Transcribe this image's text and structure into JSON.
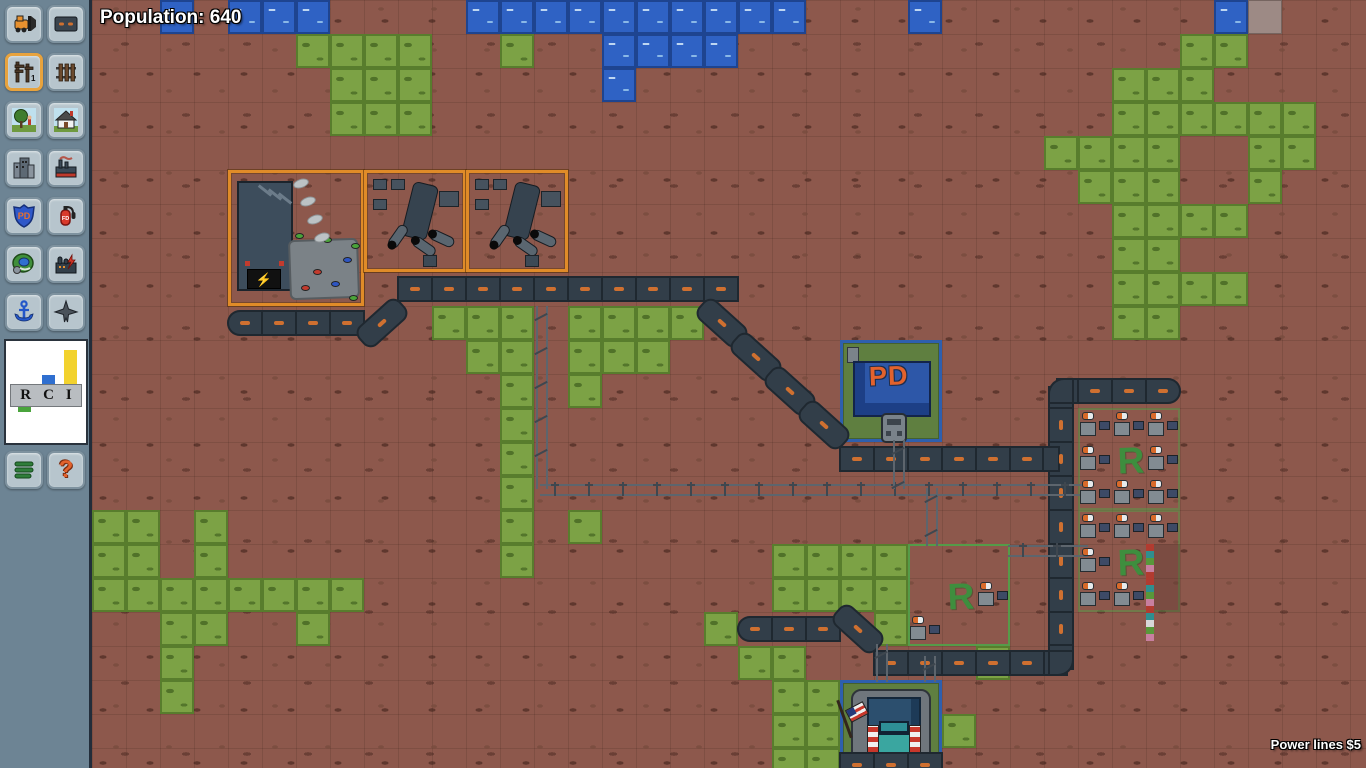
{
  "hud": {
    "population_label": "Population: 640",
    "status_label": "Power lines $5"
  },
  "sidebar": {
    "tools": [
      {
        "id": "bulldozer",
        "icon": "bulldozer-icon",
        "selected": false
      },
      {
        "id": "road",
        "icon": "road-icon",
        "selected": false
      },
      {
        "id": "power-lines",
        "icon": "power-lines-icon",
        "selected": true,
        "glyph": "1"
      },
      {
        "id": "rail",
        "icon": "rail-icon",
        "selected": false
      },
      {
        "id": "park",
        "icon": "park-icon",
        "selected": false
      },
      {
        "id": "residential",
        "icon": "residential-icon",
        "selected": false
      },
      {
        "id": "commercial",
        "icon": "commercial-icon",
        "selected": false
      },
      {
        "id": "industrial",
        "icon": "industrial-icon",
        "selected": false
      },
      {
        "id": "police",
        "icon": "police-icon",
        "selected": false,
        "glyph": "PD"
      },
      {
        "id": "fire",
        "icon": "fire-icon",
        "selected": false,
        "glyph": "FD"
      },
      {
        "id": "stadium",
        "icon": "stadium-icon",
        "selected": false
      },
      {
        "id": "power-plant",
        "icon": "power-plant-icon",
        "selected": false
      },
      {
        "id": "seaport",
        "icon": "anchor-icon",
        "selected": false
      },
      {
        "id": "airport",
        "icon": "airplane-icon",
        "selected": false
      }
    ],
    "rci": {
      "labels": {
        "r": "R",
        "c": "C",
        "i": "I"
      },
      "bars": {
        "r": -7,
        "c": 9,
        "i": 34
      },
      "colors": {
        "r": "#4aa43c",
        "c": "#2f6fd0",
        "i": "#f2d22e"
      }
    },
    "menu_icon": "menu-icon",
    "help_icon": "help-icon",
    "help_glyph": "?"
  },
  "colors": {
    "dirt": "#8d584c",
    "grass": "#7ca245",
    "water": "#2f62c4",
    "road": "#323e49",
    "road_dash": "#cf7030",
    "zone_orange": "#e08b28",
    "zone_blue": "#2e5fae",
    "zone_green": "#50a349",
    "r_letter": "#3e8e3e",
    "pd_text": "#e2622d",
    "selected_tool": "#e8a33d",
    "power_line": "#5d656d"
  },
  "map": {
    "tile_size": 34,
    "cols": 38,
    "rows": 23,
    "water": [
      [
        2,
        0
      ],
      [
        4,
        0
      ],
      [
        5,
        0
      ],
      [
        6,
        0
      ],
      [
        11,
        0
      ],
      [
        12,
        0
      ],
      [
        13,
        0
      ],
      [
        14,
        0
      ],
      [
        15,
        0
      ],
      [
        16,
        0
      ],
      [
        17,
        0
      ],
      [
        18,
        0
      ],
      [
        19,
        0
      ],
      [
        20,
        0
      ],
      [
        24,
        0
      ],
      [
        33,
        0
      ],
      [
        15,
        1
      ],
      [
        16,
        1
      ],
      [
        17,
        1
      ],
      [
        18,
        1
      ],
      [
        15,
        2
      ]
    ],
    "grass": [
      [
        6,
        1
      ],
      [
        7,
        1
      ],
      [
        8,
        1
      ],
      [
        9,
        1
      ],
      [
        12,
        1
      ],
      [
        32,
        1
      ],
      [
        33,
        1
      ],
      [
        7,
        2
      ],
      [
        8,
        2
      ],
      [
        9,
        2
      ],
      [
        30,
        2
      ],
      [
        31,
        2
      ],
      [
        32,
        2
      ],
      [
        7,
        3
      ],
      [
        8,
        3
      ],
      [
        9,
        3
      ],
      [
        30,
        3
      ],
      [
        31,
        3
      ],
      [
        32,
        3
      ],
      [
        33,
        3
      ],
      [
        34,
        3
      ],
      [
        35,
        3
      ],
      [
        28,
        4
      ],
      [
        29,
        4
      ],
      [
        30,
        4
      ],
      [
        31,
        4
      ],
      [
        34,
        4
      ],
      [
        35,
        4
      ],
      [
        29,
        5
      ],
      [
        30,
        5
      ],
      [
        31,
        5
      ],
      [
        34,
        5
      ],
      [
        30,
        6
      ],
      [
        31,
        6
      ],
      [
        32,
        6
      ],
      [
        33,
        6
      ],
      [
        30,
        7
      ],
      [
        31,
        7
      ],
      [
        30,
        8
      ],
      [
        31,
        8
      ],
      [
        32,
        8
      ],
      [
        33,
        8
      ],
      [
        10,
        9
      ],
      [
        11,
        9
      ],
      [
        12,
        9
      ],
      [
        14,
        9
      ],
      [
        15,
        9
      ],
      [
        16,
        9
      ],
      [
        17,
        9
      ],
      [
        30,
        9
      ],
      [
        31,
        9
      ],
      [
        11,
        10
      ],
      [
        12,
        10
      ],
      [
        14,
        10
      ],
      [
        15,
        10
      ],
      [
        16,
        10
      ],
      [
        12,
        11
      ],
      [
        14,
        11
      ],
      [
        12,
        12
      ],
      [
        12,
        13
      ],
      [
        12,
        14
      ],
      [
        0,
        15
      ],
      [
        1,
        15
      ],
      [
        3,
        15
      ],
      [
        12,
        15
      ],
      [
        14,
        15
      ],
      [
        0,
        16
      ],
      [
        1,
        16
      ],
      [
        3,
        16
      ],
      [
        12,
        16
      ],
      [
        20,
        16
      ],
      [
        21,
        16
      ],
      [
        22,
        16
      ],
      [
        23,
        16
      ],
      [
        0,
        17
      ],
      [
        1,
        17
      ],
      [
        2,
        17
      ],
      [
        3,
        17
      ],
      [
        4,
        17
      ],
      [
        5,
        17
      ],
      [
        6,
        17
      ],
      [
        7,
        17
      ],
      [
        20,
        17
      ],
      [
        21,
        17
      ],
      [
        22,
        17
      ],
      [
        23,
        17
      ],
      [
        2,
        18
      ],
      [
        3,
        18
      ],
      [
        6,
        18
      ],
      [
        18,
        18
      ],
      [
        23,
        18
      ],
      [
        2,
        19
      ],
      [
        19,
        19
      ],
      [
        20,
        19
      ],
      [
        26,
        19
      ],
      [
        2,
        20
      ],
      [
        20,
        20
      ],
      [
        21,
        20
      ],
      [
        20,
        21
      ],
      [
        21,
        21
      ],
      [
        25,
        21
      ],
      [
        20,
        22
      ],
      [
        21,
        22
      ]
    ],
    "light": [
      [
        34,
        0
      ]
    ],
    "roads": [
      [
        4,
        9,
        "el"
      ],
      [
        5,
        9,
        "h"
      ],
      [
        6,
        9,
        "h"
      ],
      [
        7,
        9,
        "h"
      ],
      [
        8,
        9,
        "du"
      ],
      [
        9,
        8,
        "h"
      ],
      [
        10,
        8,
        "h"
      ],
      [
        11,
        8,
        "h"
      ],
      [
        12,
        8,
        "h"
      ],
      [
        13,
        8,
        "h"
      ],
      [
        14,
        8,
        "h"
      ],
      [
        15,
        8,
        "h"
      ],
      [
        16,
        8,
        "h"
      ],
      [
        17,
        8,
        "h"
      ],
      [
        18,
        8,
        "h"
      ],
      [
        18,
        9,
        "dd"
      ],
      [
        19,
        10,
        "dd"
      ],
      [
        20,
        11,
        "dd"
      ],
      [
        21,
        12,
        "dd"
      ],
      [
        22,
        13,
        "h"
      ],
      [
        23,
        13,
        "h"
      ],
      [
        24,
        13,
        "h"
      ],
      [
        25,
        13,
        "h"
      ],
      [
        26,
        13,
        "h"
      ],
      [
        27,
        13,
        "h"
      ],
      [
        28,
        11,
        "ces"
      ],
      [
        29,
        11,
        "h"
      ],
      [
        30,
        11,
        "h"
      ],
      [
        31,
        11,
        "er"
      ],
      [
        28,
        12,
        "v"
      ],
      [
        28,
        13,
        "tw"
      ],
      [
        28,
        14,
        "v"
      ],
      [
        28,
        15,
        "v"
      ],
      [
        28,
        16,
        "v"
      ],
      [
        28,
        17,
        "v"
      ],
      [
        28,
        18,
        "v"
      ],
      [
        28,
        19,
        "cnw"
      ],
      [
        19,
        18,
        "el"
      ],
      [
        20,
        18,
        "h"
      ],
      [
        21,
        18,
        "h"
      ],
      [
        22,
        18,
        "dd"
      ],
      [
        23,
        19,
        "h"
      ],
      [
        24,
        19,
        "h"
      ],
      [
        25,
        19,
        "h"
      ],
      [
        26,
        19,
        "h"
      ],
      [
        27,
        19,
        "h"
      ],
      [
        22,
        22,
        "h"
      ],
      [
        23,
        22,
        "h"
      ],
      [
        24,
        22,
        "h"
      ]
    ],
    "power_lines": [
      {
        "dir": "v",
        "x": 448,
        "y1": 306,
        "y2": 489
      },
      {
        "dir": "h",
        "y": 488,
        "x1": 448,
        "x2": 992
      },
      {
        "dir": "v",
        "x": 805,
        "y1": 440,
        "y2": 489
      },
      {
        "dir": "v",
        "x": 838,
        "y1": 488,
        "y2": 546
      },
      {
        "dir": "h",
        "y": 549,
        "x1": 916,
        "x2": 996
      },
      {
        "dir": "v",
        "x": 788,
        "y1": 644,
        "y2": 682
      },
      {
        "dir": "v",
        "x": 836,
        "y1": 656,
        "y2": 682
      }
    ],
    "zones": [
      {
        "type": "power-plant",
        "c": 4,
        "r": 5,
        "w": 4,
        "h": 4,
        "border": "orange"
      },
      {
        "type": "industrial",
        "c": 8,
        "r": 5,
        "w": 3,
        "h": 3,
        "border": "orange"
      },
      {
        "type": "industrial",
        "c": 11,
        "r": 5,
        "w": 3,
        "h": 3,
        "border": "orange"
      },
      {
        "type": "police",
        "c": 22,
        "r": 10,
        "w": 3,
        "h": 3,
        "border": "blue",
        "label": "PD"
      },
      {
        "type": "residential",
        "c": 29,
        "r": 12,
        "w": 3,
        "h": 3,
        "label": "R",
        "soft": true
      },
      {
        "type": "residential",
        "c": 29,
        "r": 15,
        "w": 3,
        "h": 3,
        "label": "R",
        "soft": true
      },
      {
        "type": "residential",
        "c": 24,
        "r": 16,
        "w": 3,
        "h": 3,
        "label": "R",
        "soft": false
      },
      {
        "type": "station",
        "c": 22,
        "r": 20,
        "w": 3,
        "h": 3,
        "border": "blue"
      }
    ],
    "houses": [
      [
        29,
        12
      ],
      [
        30,
        12
      ],
      [
        31,
        12
      ],
      [
        29,
        13
      ],
      [
        31,
        13
      ],
      [
        29,
        14
      ],
      [
        30,
        14
      ],
      [
        31,
        14
      ],
      [
        29,
        15
      ],
      [
        30,
        15
      ],
      [
        31,
        15
      ],
      [
        29,
        16
      ],
      [
        29,
        17
      ],
      [
        30,
        17
      ],
      [
        26,
        17
      ],
      [
        24,
        18
      ]
    ],
    "dense": [
      [
        31,
        16
      ],
      [
        31,
        17
      ]
    ]
  }
}
